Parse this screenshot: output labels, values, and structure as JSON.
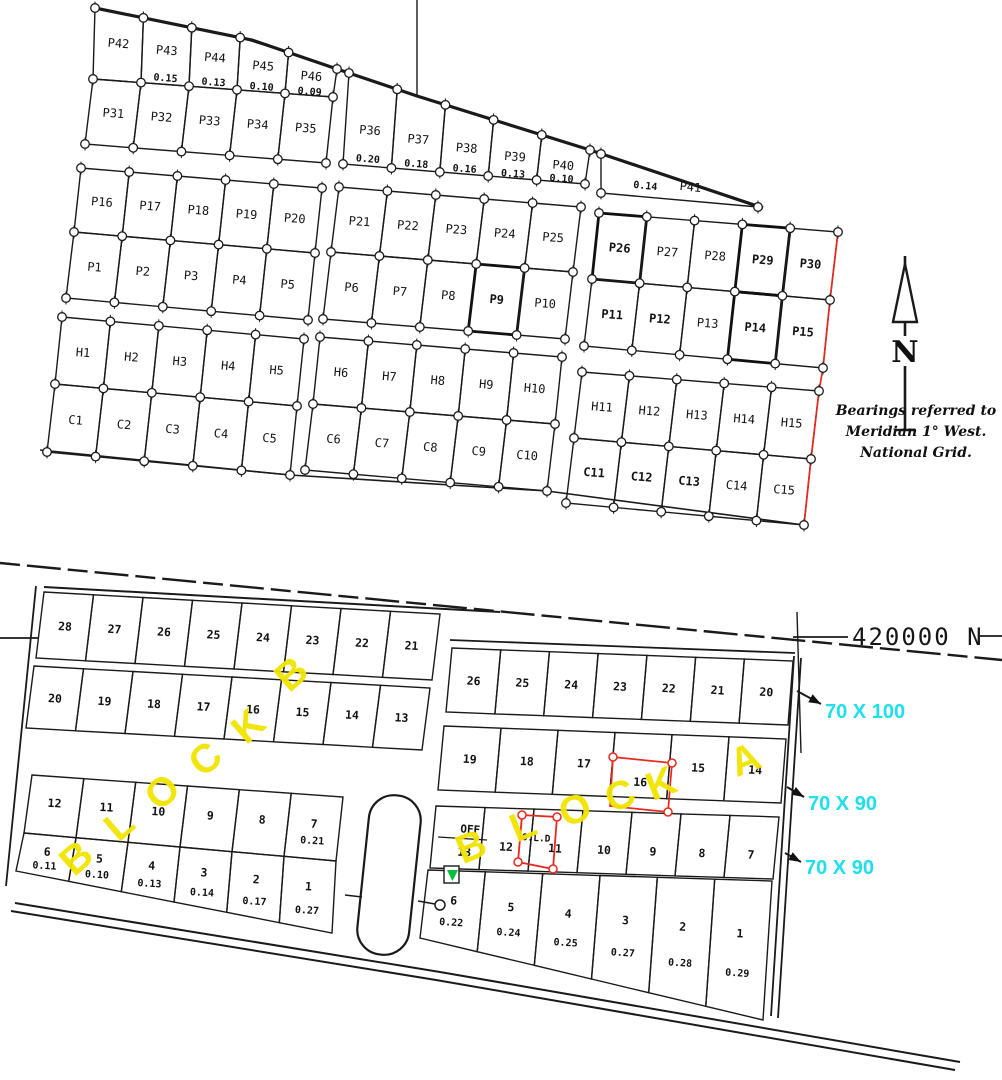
{
  "colors": {
    "ink": "#1a1a1a",
    "red": "#e8281e",
    "yellow": "#f2e400",
    "cyan": "#1fdfec",
    "green": "#00bf3a"
  },
  "annotations": {
    "north_label": "N",
    "bearings": [
      "Bearings referred to",
      "Meridian 1° West.",
      "National Grid."
    ]
  },
  "upper_plan": {
    "blocks": [
      {
        "id": "west",
        "rows": [
          {
            "labels": [
              "P42",
              "P43",
              "P44",
              "P45",
              "P46"
            ],
            "areas": [
              "",
              "0.15",
              "0.13",
              "0.10",
              "0.09"
            ]
          },
          {
            "labels": [
              "P31",
              "P32",
              "P33",
              "P34",
              "P35"
            ]
          },
          {
            "labels": [
              "P16",
              "P17",
              "P18",
              "P19",
              "P20"
            ]
          },
          {
            "labels": [
              "P1",
              "P2",
              "P3",
              "P4",
              "P5"
            ]
          },
          {
            "labels": [
              "H1",
              "H2",
              "H3",
              "H4",
              "H5"
            ]
          },
          {
            "labels": [
              "C1",
              "C2",
              "C3",
              "C4",
              "C5"
            ]
          }
        ]
      },
      {
        "id": "middle",
        "rows": [
          {
            "labels": [
              "P36",
              "P37",
              "P38",
              "P39",
              "P40"
            ],
            "areas": [
              "0.20",
              "0.18",
              "0.16",
              "0.13",
              "0.10"
            ]
          },
          {
            "labels": [
              "P21",
              "P22",
              "P23",
              "P24",
              "P25"
            ]
          },
          {
            "labels": [
              "P6",
              "P7",
              "P8",
              "P9",
              "P10"
            ],
            "bold": [
              3
            ]
          },
          {
            "labels": [
              "H6",
              "H7",
              "H8",
              "H9",
              "H10"
            ]
          },
          {
            "labels": [
              "C6",
              "C7",
              "C8",
              "C9",
              "C10"
            ]
          }
        ]
      },
      {
        "id": "east",
        "wedge": {
          "label": "P41",
          "area": "0.14"
        },
        "rows": [
          {
            "labels": [
              "P26",
              "P27",
              "P28",
              "P29",
              "P30"
            ],
            "bold": [
              0,
              3,
              4
            ]
          },
          {
            "labels": [
              "P11",
              "P12",
              "P13",
              "P14",
              "P15"
            ],
            "bold": [
              0,
              1,
              3,
              4
            ]
          },
          {
            "labels": [
              "H11",
              "H12",
              "H13",
              "H14",
              "H15"
            ]
          },
          {
            "labels": [
              "C11",
              "C12",
              "C13",
              "C14",
              "C15"
            ],
            "bold": [
              0,
              1,
              2
            ]
          }
        ]
      }
    ]
  },
  "lower_plan": {
    "northing_label": "420000 N",
    "dim_labels": [
      "70 X 100",
      "70 X 90",
      "70 X 90"
    ],
    "block_b": {
      "title": "BLOCK B",
      "rows": [
        {
          "labels": [
            "28",
            "27",
            "26",
            "25",
            "24",
            "23",
            "22",
            "21"
          ]
        },
        {
          "labels": [
            "20",
            "19",
            "18",
            "17",
            "16",
            "15",
            "14",
            "13"
          ]
        },
        {
          "labels": [
            "12",
            "11",
            "10",
            "9",
            "8",
            "7"
          ],
          "areas": [
            "",
            "",
            "",
            "",
            "",
            "0.21"
          ]
        },
        {
          "labels": [
            "6",
            "5",
            "4",
            "3",
            "2",
            "1"
          ],
          "areas": [
            "0.11",
            "0.10",
            "0.13",
            "0.14",
            "0.17",
            "0.27"
          ]
        }
      ]
    },
    "block_a": {
      "title": "BLOCK A",
      "off_label": "OFF",
      "old_label": "O.L.D",
      "rows": [
        {
          "labels": [
            "26",
            "25",
            "24",
            "23",
            "22",
            "21",
            "20"
          ]
        },
        {
          "labels": [
            "19",
            "18",
            "17",
            "16",
            "15",
            "14"
          ],
          "red_plot_index": 3
        },
        {
          "labels": [
            "13",
            "12",
            "11",
            "10",
            "9",
            "8",
            "7"
          ]
        },
        {
          "labels": [
            "6",
            "5",
            "4",
            "3",
            "2",
            "1"
          ],
          "areas": [
            "0.22",
            "0.24",
            "0.25",
            "0.27",
            "0.28",
            "0.29"
          ]
        }
      ]
    }
  }
}
